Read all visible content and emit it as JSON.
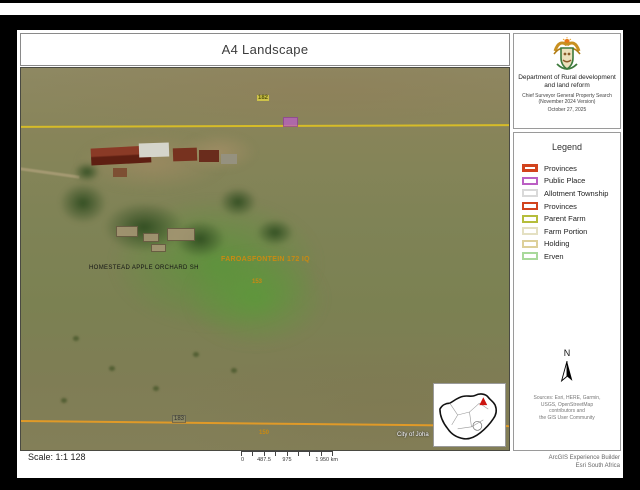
{
  "window": {
    "title": "A4 Landscape"
  },
  "header": {
    "dept_line1": "Department of Rural development",
    "dept_line2": "and land reform",
    "sub_line1": "Chief Surveyor General Property Search",
    "sub_line2": "(November 2024 Version)",
    "date": "October 27, 2025"
  },
  "legend": {
    "title": "Legend",
    "items": [
      {
        "label": "Provinces",
        "color": "#d2431d",
        "weight": 3
      },
      {
        "label": "Public Place",
        "color": "#bb5fc4",
        "weight": 2
      },
      {
        "label": "Allotment Township",
        "color": "#d9d9d9",
        "weight": 2
      },
      {
        "label": "Provinces",
        "color": "#d2431d",
        "weight": 2
      },
      {
        "label": "Parent Farm",
        "color": "#b5bd3b",
        "weight": 2
      },
      {
        "label": "Farm Portion",
        "color": "#e4e0c2",
        "weight": 2
      },
      {
        "label": "Holding",
        "color": "#ddd09a",
        "weight": 2
      },
      {
        "label": "Erven",
        "color": "#a9d99b",
        "weight": 2
      }
    ]
  },
  "map": {
    "labels": {
      "parcel_top": "182",
      "farm_name": "FAROASFONTEIN 172 IQ",
      "homestead": "HOMESTEAD APPLE ORCHARD SH",
      "parcel_mid": "153",
      "parcel_bottom_left": "183",
      "parcel_bottom": "150",
      "city": "City of Joha"
    },
    "colors": {
      "boundary_line_top": "#d6bc28",
      "boundary_line_bottom": "#e09a28",
      "farm_label": "#c98a12",
      "public_place_fill": "#bb5fc4"
    }
  },
  "north_arrow": {
    "label": "N"
  },
  "sources": {
    "line1": "Sources: Esri, HERE, Garmin,",
    "line2": "USGS, OpenStreetMap",
    "line3": "contributors and",
    "line4": "the GIS User Community"
  },
  "scale": {
    "text": "Scale: 1:1 128",
    "bar_labels": [
      "0",
      "487.5",
      "975",
      "1 950 km"
    ]
  },
  "footer": {
    "line1": "ArcGIS Experience Builder",
    "line2": "Esri South Africa"
  }
}
